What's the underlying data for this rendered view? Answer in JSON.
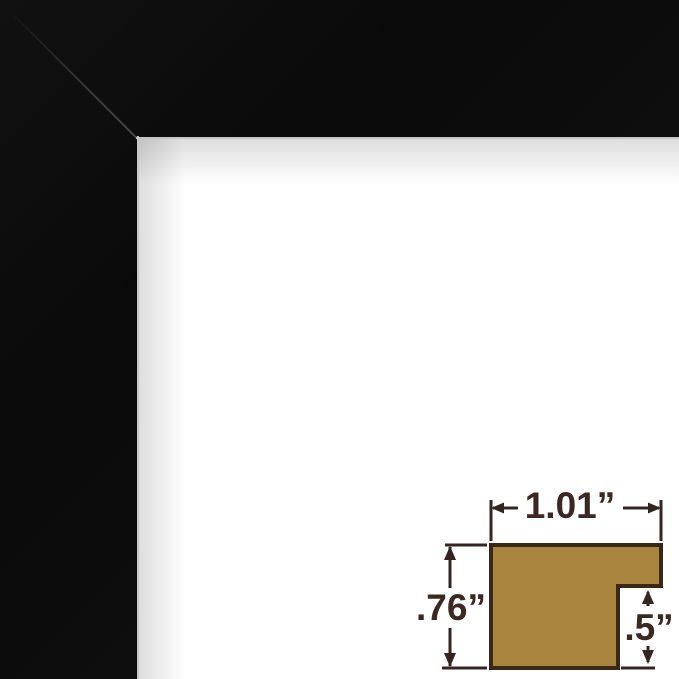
{
  "page": {
    "background_color": "#ffffff"
  },
  "frame_photo": {
    "frame_color": "#0c0c0c",
    "interior_color": "#ffffff",
    "bevel_color": "#c6c6c6"
  },
  "diagram": {
    "type": "moulding-cross-section",
    "profile_fill_color": "#a8843e",
    "profile_outline_color": "#3a2817",
    "dimension_line_color": "#352520",
    "text_color": "#3b2822",
    "width_label": "1.01”",
    "height_label": ".76”",
    "rabbet_label": ".5”",
    "measurements": {
      "moulding_width_inches": 1.01,
      "moulding_height_inches": 0.76,
      "rabbet_depth_inches": 0.5
    }
  }
}
